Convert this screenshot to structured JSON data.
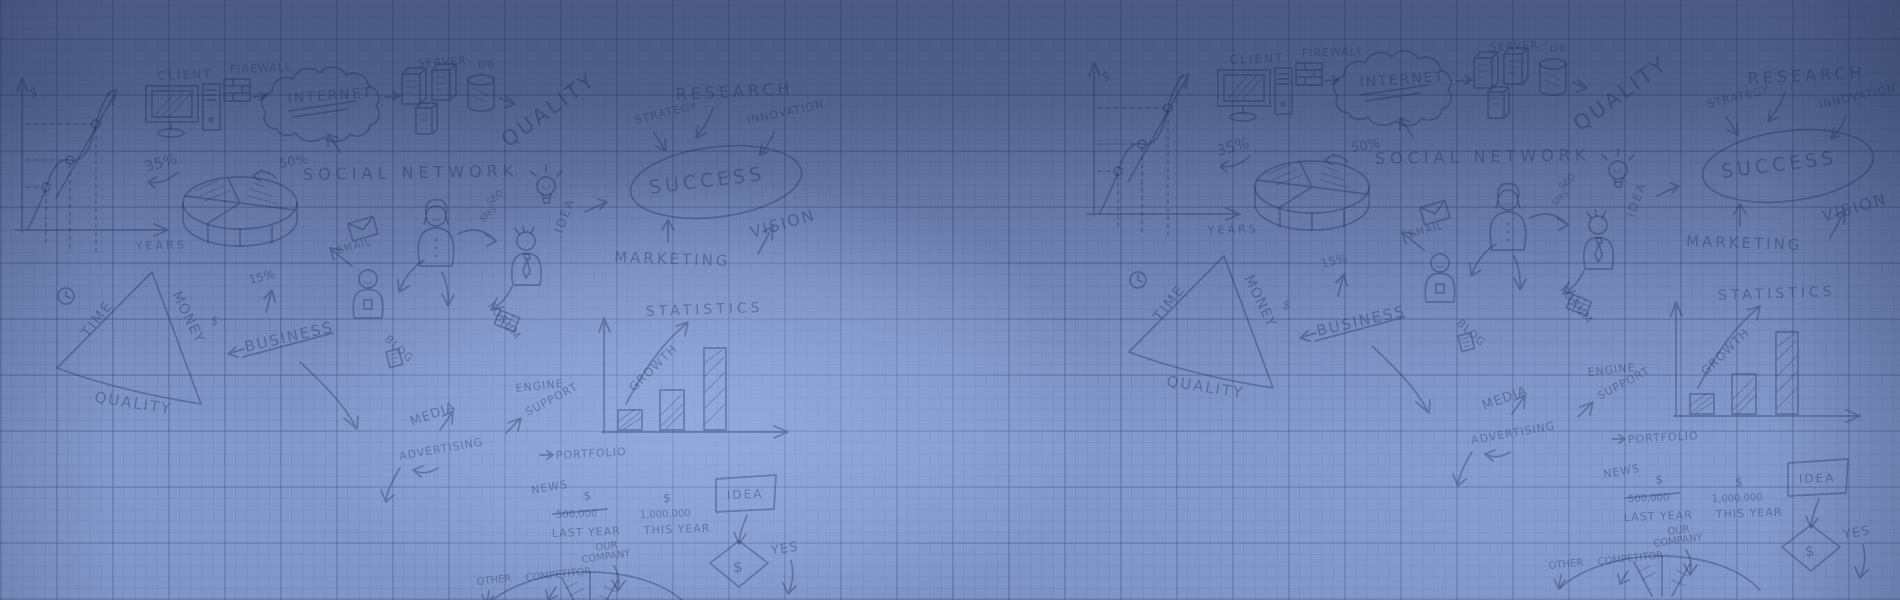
{
  "meta": {
    "description": "Blue graph-paper banner covered with hand-drawn business strategy doodles, tiled twice"
  },
  "colors": {
    "bg_top": "#4c5a85",
    "bg_middle": "#7285b5",
    "bg_bottom": "#7e93c5",
    "bg_highlight": "#9db8ea",
    "grid_line": "#26345c",
    "ink": "#1e2c55"
  },
  "doodle": {
    "chart": {
      "dollar": "$",
      "years": "YEARS",
      "pct35": "35%",
      "pct50": "50%",
      "pct15": "15%"
    },
    "it": {
      "client": "CLIENT",
      "firewall": "FIREWALL",
      "internet": "INTERNET",
      "server": "SERVER",
      "db": "DB",
      "social_network": "SOCIAL NETWORK",
      "quality": "QUALITY"
    },
    "vision": {
      "research": "RESEARCH",
      "innovation": "INNOVATION",
      "strategy": "STRATEGY",
      "success": "SUCCESS",
      "vision": "VISION",
      "marketing": "MARKETING",
      "idea": "IDEA",
      "seo": "SEO",
      "sms": "SMS"
    },
    "balance": {
      "time": "TIME",
      "money": "MONEY",
      "quality": "QUALITY",
      "business": "BUSINESS",
      "dollar": "$"
    },
    "channels": {
      "email": "EMAIL",
      "blog": "BLOG",
      "media": "MEDIA",
      "advertising": "ADVERTISING",
      "forum": "FORUM"
    },
    "stats": {
      "title": "STATISTICS",
      "growth": "GROWTH"
    },
    "services": {
      "engine": "ENGINE",
      "support": "SUPPORT",
      "portfolio": "PORTFOLIO",
      "news": "NEWS"
    },
    "compare": {
      "dollar": "$",
      "last_year_value": "500,000",
      "last_year": "LAST YEAR",
      "this_year_value": "1,000,000",
      "this_year": "THIS YEAR"
    },
    "decision": {
      "idea": "IDEA",
      "dollar": "$",
      "yes": "YES"
    },
    "market": {
      "our": "OUR",
      "company": "COMPANY",
      "competitor": "COMPETITOR",
      "other": "OTHER"
    }
  }
}
